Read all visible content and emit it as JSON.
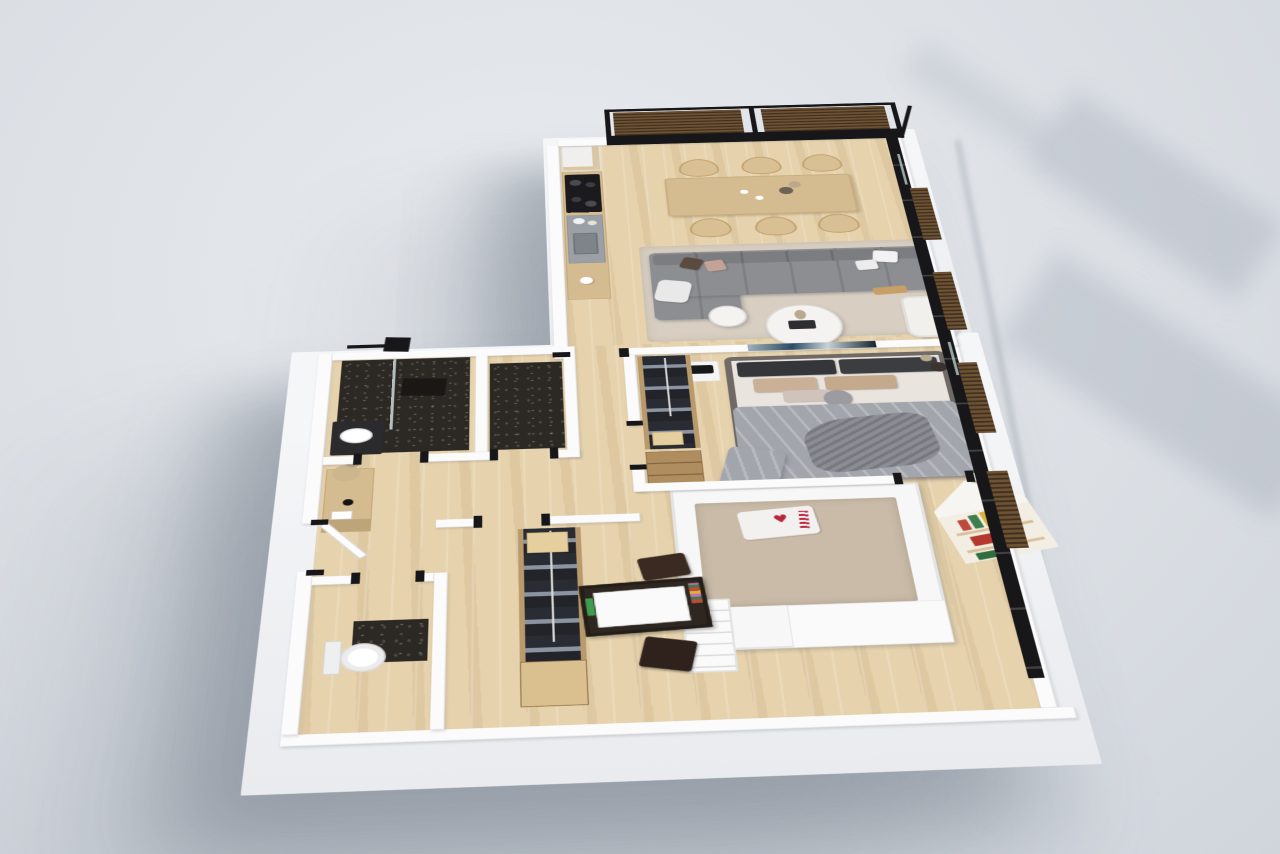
{
  "scene": {
    "type": "isometric-3d-floor-plan-render",
    "style": "photorealistic apartment dollhouse view on gray studio background",
    "visible_text": "none",
    "icons": {
      "heart": "♥"
    }
  },
  "palette": {
    "bg": "#dde1e6",
    "bg_light": "#e8ebef",
    "bg_dark": "#d0d5dc",
    "shadow": "rgba(100,110,125,0.45)",
    "wall": "#fbfbfc",
    "plinth": "#f5f6f8",
    "floor": "#e6d3ad",
    "rug": "#d8cfc2",
    "dark_floor": "#2c2823",
    "frame_black": "#17171a",
    "slat_light": "#6d5334",
    "slat_dark": "#43311f",
    "wood": "#d5bc90",
    "wood_deep": "#b08d5f",
    "steel": "#9aa0a6",
    "sofa": "#8d8e92",
    "sofa_dark": "#7b7d81",
    "bed_frame": "#6f6a66",
    "duvet": "#a2a6ac",
    "blanket": "#8a8d93",
    "pillow_dark": "#35363a",
    "pillow_tan": "#c9b096",
    "blush": "#c2a396",
    "white_soft": "#f4f3f1",
    "mattress_kids": "#c9bba8",
    "heart_red": "#b8273d",
    "art_blue": "#2d4a63",
    "art_pale": "#c6d2d8",
    "clothes_dark": "#26272c",
    "clothes_gray": "#8b94a0",
    "accent_green": "#3f7d4e",
    "accent_red": "#c04a3a",
    "accent_blue": "#3b5f9e",
    "accent_yellow": "#d9b23a",
    "chair_brown": "#3a2a22"
  },
  "rooms": [
    {
      "name": "kitchen-dining-living",
      "floor": "light-oak-plank",
      "features": [
        "kitchen-counter",
        "cooktop",
        "sink",
        "tall-cabinet",
        "dining-table",
        "six-wishbone-chairs",
        "gray-sectional-sofa",
        "round-coffee-table",
        "side-table",
        "white-armchair",
        "wood-bench",
        "area-rug",
        "glazed-wall-with-wood-slat-screens"
      ]
    },
    {
      "name": "master-bedroom",
      "floor": "light-oak-plank",
      "features": [
        "upholstered-double-bed",
        "gray-duvet",
        "dark-and-tan-pillows",
        "open-wardrobe",
        "dresser",
        "nightstand",
        "black-radio",
        "abstract-wall-art",
        "vase"
      ]
    },
    {
      "name": "bathroom",
      "floor": "black-terrazzo",
      "features": [
        "walk-in-shower",
        "glass-screen",
        "black-rain-shower-head",
        "dark-vanity-with-white-basin"
      ]
    },
    {
      "name": "shower-room",
      "floor": "black-terrazzo",
      "features": []
    },
    {
      "name": "hallway",
      "floor": "light-oak-plank",
      "features": [
        "console-table",
        "dried-plant",
        "table-lamp",
        "books",
        "entry-door-ajar"
      ]
    },
    {
      "name": "kids-room",
      "floor": "light-oak-plank",
      "features": [
        "white-loft-bed",
        "bed-stairs",
        "heart-print-pillow",
        "house-shaped-bookshelf",
        "colorful-books",
        "pennant-flag",
        "open-wardrobe",
        "storage-boxes",
        "desk",
        "two-dark-chairs"
      ]
    },
    {
      "name": "wc",
      "floor": "light-oak-plank-with-dark-inset",
      "features": [
        "toilet"
      ]
    }
  ],
  "exterior": {
    "window_wall": "black-framed glazing along east side with vertical wood-slat panels",
    "north_screen": "two dark wood louver panels above kitchen-living glazing",
    "base": "thick white plinth slab casting soft shadow to lower-left",
    "cast_shadows": "diagonal window-frame shadows on background to the right"
  }
}
